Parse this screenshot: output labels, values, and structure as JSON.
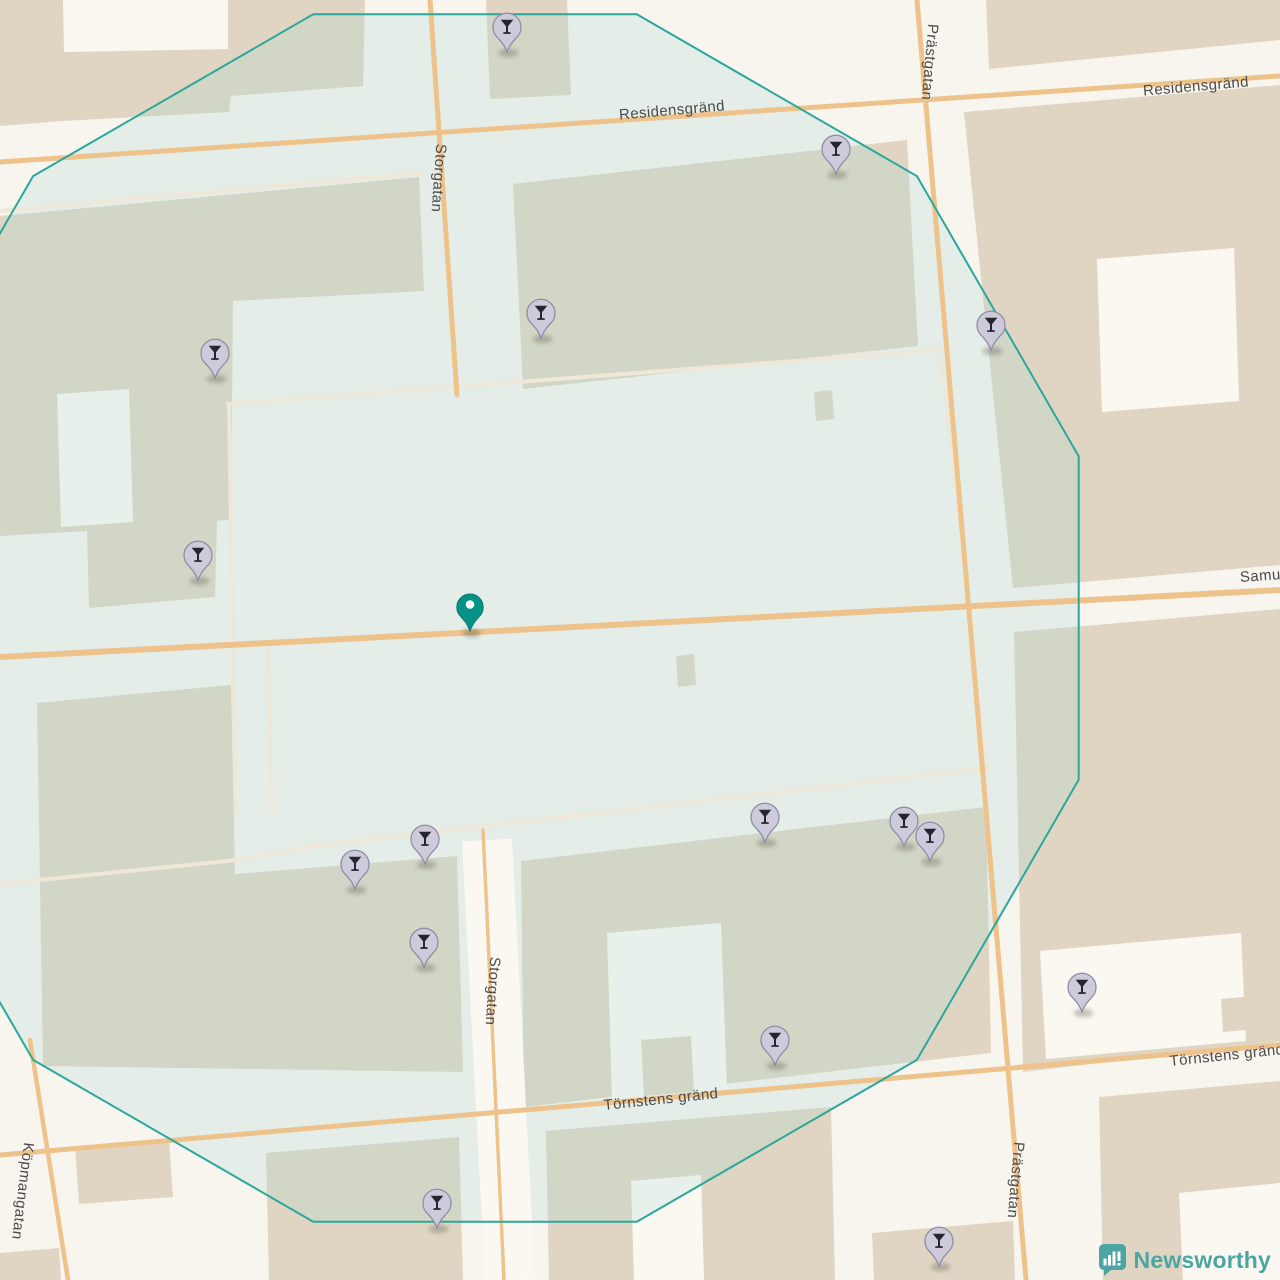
{
  "map": {
    "streets": {
      "residensgrand_w": "Residensgränd",
      "residensgrand_e": "Residensgränd",
      "storgatan_n": "Storgatan",
      "storgatan_s": "Storgatan",
      "prastgatan_n": "Prästgatan",
      "prastgatan_s": "Prästgatan",
      "kopmangatan": "Köpmangatan",
      "tornstens_c": "Törnstens gränd",
      "tornstens_e": "Törnstens gränd",
      "samuelsgatan_partial": "Samu"
    },
    "pin_icon": "cocktail-glass-icon",
    "pins": [
      {
        "x": 507,
        "y": 28
      },
      {
        "x": 836,
        "y": 150
      },
      {
        "x": 541,
        "y": 314
      },
      {
        "x": 215,
        "y": 354
      },
      {
        "x": 991,
        "y": 326
      },
      {
        "x": 198,
        "y": 556
      },
      {
        "x": 765,
        "y": 818
      },
      {
        "x": 904,
        "y": 822
      },
      {
        "x": 930,
        "y": 837
      },
      {
        "x": 425,
        "y": 840
      },
      {
        "x": 355,
        "y": 865
      },
      {
        "x": 424,
        "y": 943
      },
      {
        "x": 1082,
        "y": 988
      },
      {
        "x": 775,
        "y": 1041
      },
      {
        "x": 437,
        "y": 1204
      },
      {
        "x": 939,
        "y": 1242
      }
    ],
    "center_marker": {
      "x": 470,
      "y": 607
    },
    "radius_overlay": {
      "center_x": 475,
      "center_y": 618,
      "radius": 625,
      "sides": 12,
      "rotation_deg": 15
    },
    "colors": {
      "background": "#f8f4ee",
      "building": "#e0d5c3",
      "building_light": "#fbf8f2",
      "road_major": "#eec28b",
      "road_minor": "#efe7d8",
      "circle_stroke": "#2ba79c",
      "circle_fill": "rgba(168,216,210,0.24)",
      "pin_body": "#cdcadb",
      "pin_border": "#8f8da3",
      "pin_glyph": "#26242e",
      "marker_teal": "#089186",
      "label_text": "#4b4b4b",
      "brand_teal": "#4ba5a2"
    }
  },
  "logo": {
    "brand": "Newsworthy"
  }
}
